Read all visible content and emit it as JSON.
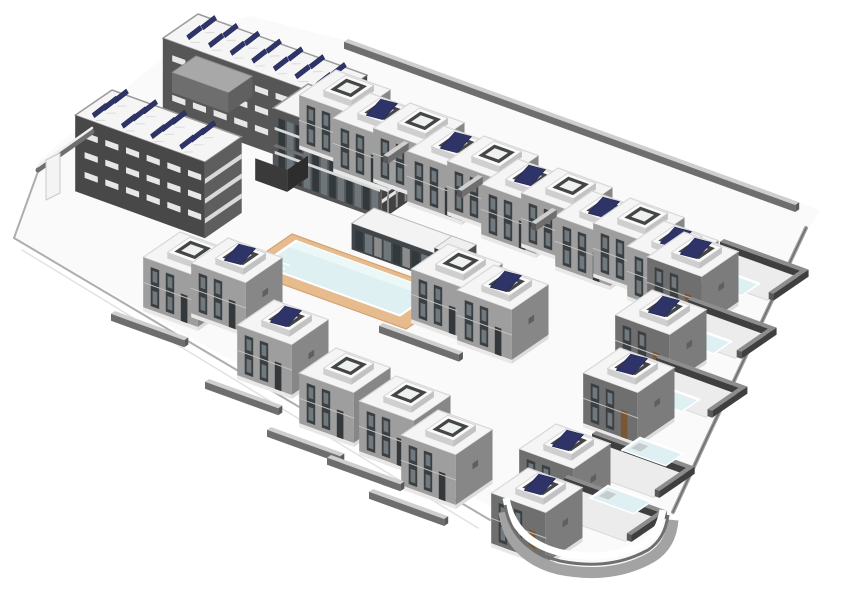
{
  "meta": {
    "description": "Axonometric 3D architectural model of a residential complex: apartment block with rooftop solar panels, villa rows with roof terraces, central swimming pool with tan deck and clubhouse, villas with private pools, curved corner retaining wall",
    "background": "#ffffff"
  },
  "projection": {
    "ax": 0.94,
    "ay": 0.34,
    "bx": -0.8,
    "by": 0.55
  },
  "colors": {
    "roof": "#f5f5f5",
    "roofStroke": "#d8d8d8",
    "swFace": "#9e9e9e",
    "seFace": "#878787",
    "swDark": "#6f6f6f",
    "darkFace": "#4a4a4a",
    "windowDark": "#3b3f42",
    "glass": "#70797e",
    "panelNavy": "#2e3467",
    "poolWater": "#def0f2",
    "poolLight": "#ecf7f8",
    "deckTan": "#e6bc8e",
    "deckEdge": "#d5a271",
    "ground": "#fafafa",
    "edgeLine": "#aeaeae",
    "edgeLineLight": "#e2e2e2",
    "wallTop": "#cfcfcf",
    "wallFace": "#6e6e6e",
    "wallEnd": "#5a5a5a",
    "yardWallTop": "#8d8d8d",
    "yardWallFace": "#3f3f3f",
    "terrace": "#ececec",
    "terraceStroke": "#d9d9d9",
    "white": "#ffffff",
    "slab": "#e3e3e3",
    "pier": "#8f8f8f",
    "glazingDark": "#31393d",
    "glazingLight": "#6d767b",
    "doorDark": "#34383b",
    "doorBrown": "#7b5634",
    "plinth": "#e8e8e8",
    "plinthSE": "#dcdcdc",
    "courtWall": "#3a3a3a",
    "courtWallSE": "#2d2d2d",
    "courtFloor": "#cccccc",
    "stepGray": "#c7cbce",
    "slitWhite": "#e7e7e7",
    "ringTop": "#fafafa",
    "ringSW": "#cfcfcf",
    "ringSE": "#c2c2c2",
    "ringInner": "#454545",
    "ringFloor": "#eef1f1",
    "boundary": "#9f9f9f",
    "boundaryInner": "#6f6f6f",
    "curveGray": "#a3a3a3",
    "curveDark": "#6f6f6f"
  },
  "villaGeom": {
    "w": 58,
    "d": 46,
    "h": 50,
    "terrace": {
      "a0": 18,
      "b0": 9,
      "aw": 30,
      "bd": 28,
      "z": 6
    }
  },
  "ground": {
    "outline": [
      [
        40,
        160
      ],
      [
        198,
        28
      ],
      [
        250,
        16
      ],
      [
        352,
        42
      ],
      [
        820,
        210
      ],
      [
        806,
        232
      ],
      [
        758,
        332
      ],
      [
        708,
        438
      ],
      [
        673,
        516
      ],
      [
        650,
        560
      ],
      [
        596,
        574
      ],
      [
        540,
        556
      ],
      [
        504,
        514
      ],
      [
        14,
        238
      ]
    ],
    "edges": [
      {
        "pts": [
          [
            14,
            238
          ],
          [
            490,
            520
          ]
        ],
        "color": "edgeLine",
        "w": 2
      },
      {
        "pts": [
          [
            22,
            250
          ],
          [
            478,
            528
          ]
        ],
        "color": "edgeLineLight",
        "w": 1.5
      },
      {
        "pts": [
          [
            14,
            238
          ],
          [
            40,
            166
          ]
        ],
        "color": "edgeLine",
        "w": 2
      }
    ],
    "boundaryRight": {
      "path": "M 806 228 L 758 330 L 708 436 L 673 512"
    }
  },
  "apartment": {
    "wings": [
      {
        "name": "apartment-wing-top",
        "x": 198,
        "y": 14,
        "w": 180,
        "d": 44,
        "h": 76,
        "sw": "#565656",
        "se": "#474747",
        "swStyle": "slits",
        "panels": {
          "rows": 2,
          "cols": 7,
          "a0": 16,
          "b0": 9,
          "da": 23,
          "db": 18
        }
      },
      {
        "name": "apartment-wing-left",
        "x": 112,
        "y": 90,
        "w": 138,
        "d": 46,
        "h": 76,
        "sw": "#484848",
        "se": "#5e5e5e",
        "swStyle": "slits",
        "seStyle": "bands",
        "panels": {
          "rows": 3,
          "cols": 4,
          "a0": 12,
          "b0": 7,
          "da": 31,
          "db": 13
        }
      },
      {
        "name": "apartment-wing-right",
        "x": 308,
        "y": 84,
        "w": 116,
        "d": 44,
        "h": 72,
        "sw": "#555555",
        "se": "#424242",
        "swStyle": "glazing",
        "seStyle": "balconies"
      }
    ],
    "penthouse": {
      "x": 196,
      "y": 56,
      "w": 60,
      "d": 30,
      "h": 20,
      "top": "#a8a8a8",
      "sw": "#6e6e6e",
      "se": "#606060"
    },
    "court": {
      "x": 276,
      "y": 166,
      "w": 34,
      "d": 26,
      "h": 22
    }
  },
  "gate": {
    "line": [
      [
        38,
        170
      ],
      [
        92,
        132
      ]
    ],
    "panel": [
      [
        46,
        160
      ],
      [
        60,
        153
      ],
      [
        60,
        193
      ],
      [
        46,
        200
      ]
    ]
  },
  "topRow": {
    "offset": [
      34,
      23
    ],
    "pairs": [
      [
        336,
        70
      ],
      [
        410,
        103
      ],
      [
        484,
        136
      ],
      [
        558,
        168
      ],
      [
        630,
        198
      ]
    ]
  },
  "clubhouse": {
    "x": 374,
    "y": 208,
    "w": 88,
    "d": 28,
    "h": 26,
    "annex": {
      "x": 452,
      "y": 236,
      "w": 26,
      "d": 22,
      "h": 18
    }
  },
  "poolArea": {
    "deck": {
      "x": 292,
      "y": 234,
      "w": 176,
      "d": 64
    },
    "pool": {
      "x": 296,
      "y": 241,
      "w": 148,
      "d": 44
    }
  },
  "leftVillas": [
    {
      "x": 180,
      "y": 232,
      "panel": false
    },
    {
      "x": 228,
      "y": 238,
      "panel": true
    },
    {
      "x": 274,
      "y": 300,
      "panel": true
    }
  ],
  "centerPair": {
    "x": 448,
    "y": 244,
    "offset": [
      46,
      21
    ]
  },
  "bottomRow": [
    {
      "x": 336,
      "y": 348,
      "panel": false
    },
    {
      "x": 396,
      "y": 376,
      "panel": false
    },
    {
      "x": 438,
      "y": 410,
      "panel": false
    }
  ],
  "rightColumn": [
    {
      "x": 684,
      "y": 232,
      "pool": [
        716,
        268
      ],
      "yardW": 85
    },
    {
      "x": 652,
      "y": 290,
      "pool": [
        688,
        326
      ],
      "yardW": 85
    },
    {
      "x": 620,
      "y": 348,
      "pool": [
        656,
        384
      ],
      "yardW": 88
    },
    {
      "x": 556,
      "y": 424,
      "pool": [
        640,
        438
      ],
      "yardW": 100
    },
    {
      "x": 528,
      "y": 468,
      "pool": [
        608,
        486
      ],
      "yardW": 100
    }
  ],
  "walls": [
    {
      "x": 348,
      "y": 46,
      "len": 480,
      "dir": "A"
    },
    {
      "x": 404,
      "y": 148,
      "len": 26,
      "dir": "B"
    },
    {
      "x": 478,
      "y": 182,
      "len": 26,
      "dir": "B"
    },
    {
      "x": 552,
      "y": 215,
      "len": 26,
      "dir": "B"
    },
    {
      "x": 115,
      "y": 318,
      "len": 78,
      "dir": "A"
    },
    {
      "x": 209,
      "y": 386,
      "len": 78,
      "dir": "A"
    },
    {
      "x": 383,
      "y": 330,
      "len": 85,
      "dir": "A"
    },
    {
      "x": 271,
      "y": 434,
      "len": 78,
      "dir": "A"
    },
    {
      "x": 331,
      "y": 462,
      "len": 78,
      "dir": "A"
    },
    {
      "x": 373,
      "y": 496,
      "len": 80,
      "dir": "A"
    }
  ],
  "curve": {
    "outer": "M 504 512 Q 510 556 558 569 Q 612 580 652 557 Q 671 545 673 520",
    "mid": "M 505 505 Q 512 549 560 561 Q 610 571 648 550 Q 665 539 668 515",
    "white": "M 506 498 Q 514 542 562 553 Q 610 562 644 543 Q 659 534 663 510",
    "widthOuter": 11,
    "widthMid": 3,
    "widthWhite": 7
  }
}
